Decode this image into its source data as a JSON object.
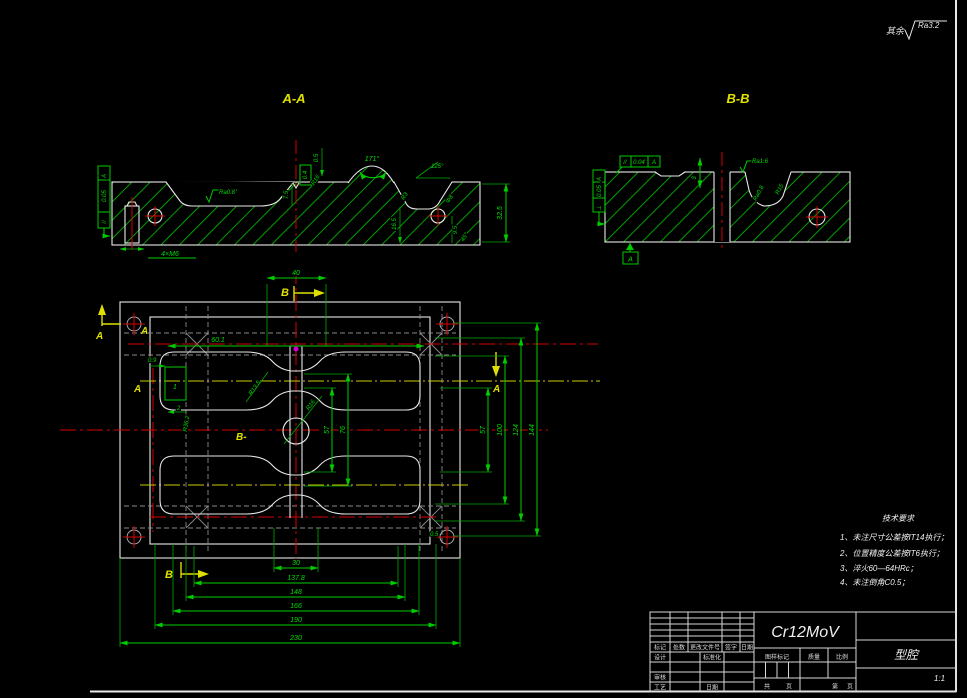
{
  "frame": {
    "surface_prefix": "其余",
    "surface_value": "Ra3.2"
  },
  "section_aa": {
    "title": "A-A",
    "ra": "Ra0.8",
    "dim_05": "0.5",
    "dim_75": "7.5",
    "dim_04": "0.4",
    "r16": "R16",
    "ang_171": "171°",
    "ang_125": "125°",
    "r3": "R3",
    "phi8": "Φ8",
    "dim_165": "16.5",
    "dim_95": "9.5",
    "ang_45": "45°",
    "dim_325": "32.5",
    "thread": "4×M6",
    "tol_symbol": "//",
    "tol_value": "0.05",
    "tol_datum": "A"
  },
  "section_bb": {
    "title": "B-B",
    "ra_top": "Ra1.6",
    "ra_pocket": "Ra0.8",
    "r15": "R15",
    "dim_3": "3",
    "tol_par_sym": "//",
    "tol_par_val": "0.04",
    "tol_par_datum": "A",
    "tol_perp_sym": "⊥",
    "tol_perp_val": "0.05",
    "tol_perp_datum": "A",
    "datum_flag": "A"
  },
  "plan": {
    "dim_top": "40",
    "dims_bottom": [
      "30",
      "137.8",
      "148",
      "166",
      "190",
      "230"
    ],
    "dims_right": [
      "57",
      "100",
      "124",
      "144"
    ],
    "dim_mid_57": "57",
    "dim_mid_76": "76",
    "dim_601": "60.1",
    "dim_09": "0.9",
    "dim_2": "2",
    "detail_1": "1",
    "r362": "R36.2",
    "r135": "R13.5",
    "r16": "R16",
    "dim_05": "0.5",
    "marker_a": "A",
    "marker_b": "B",
    "marker_b_mid": "B-"
  },
  "tech_req": {
    "title": "技术要求",
    "items": [
      "1、未注尺寸公差按IT14执行；",
      "2、位置精度公差按IT6执行；",
      "3、淬火60—64HRc；",
      "4、未注倒角C0.5；"
    ]
  },
  "title_block": {
    "material": "Cr12MoV",
    "part_name": "型腔",
    "scale_value": "1:1",
    "mark": "标记",
    "count": "处数",
    "change_doc": "更改文件号",
    "sign": "签字",
    "date": "日期",
    "design": "设计",
    "standardize": "标准化",
    "check": "审核",
    "process": "工艺",
    "date2": "日期",
    "drawing_mark": "图样标记",
    "weight": "质量",
    "scale": "比例",
    "total": "共",
    "sheet": "页",
    "no": "第",
    "sheet2": "页"
  }
}
